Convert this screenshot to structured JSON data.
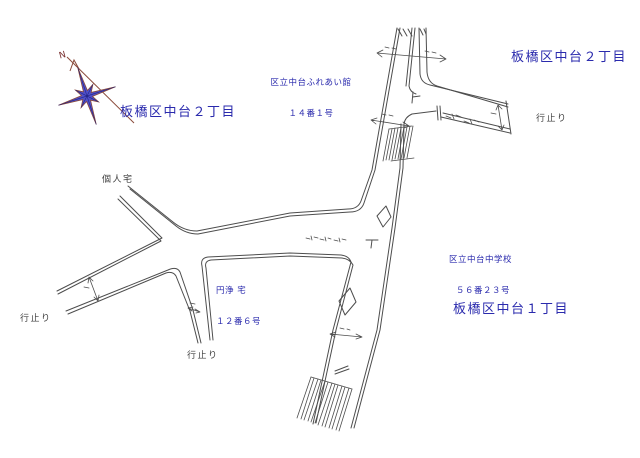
{
  "canvas": {
    "width": 640,
    "height": 458,
    "background": "#ffffff"
  },
  "colors": {
    "label_blue": "#2a2aad",
    "label_black": "#3f3f3f",
    "road_line": "#4d4d4d",
    "compass_star_blue": "#3c3cc2",
    "compass_brown": "#8a4a3a"
  },
  "labels": {
    "district_nakadai2_left": "板橋区中台２丁目",
    "district_nakadai2_right": "板橋区中台２丁目",
    "district_nakadai1": "板橋区中台１丁目",
    "fureaikan_name": "区立中台ふれあい館",
    "fureaikan_address": "１４番１号",
    "school_name": "区立中台中学校",
    "school_address": "５６番２３号",
    "enjo_name": "円浄 宅",
    "enjo_address": "１２番６号",
    "private_house": "個人宅",
    "dead_end_right": "行止り",
    "dead_end_left": "行止り",
    "dead_end_bottom": "行止り",
    "compass_north": "N"
  }
}
